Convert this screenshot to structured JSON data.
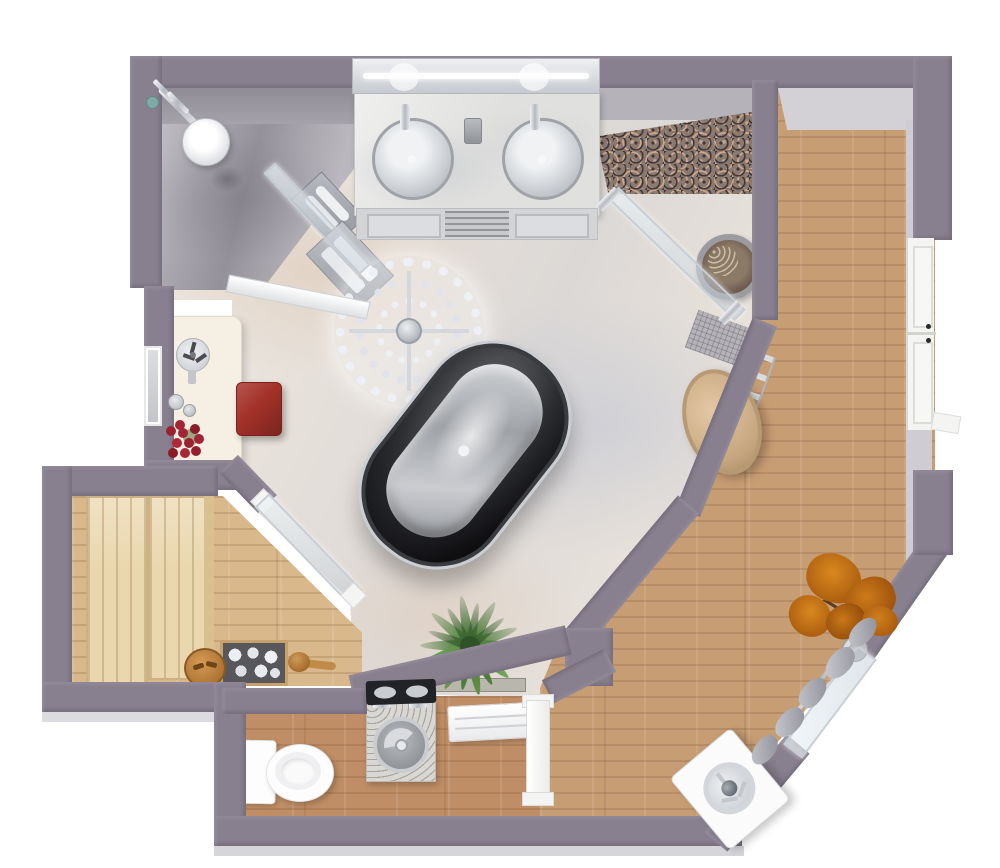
{
  "meta": {
    "type": "3d-floor-plan-render",
    "description": "Top-down 3D rendering of a luxury master bathroom suite with sauna, walk-in shower, freestanding tub, WC and wood-floored dressing corridor",
    "canvas": {
      "width": 1000,
      "height": 868
    }
  },
  "palette": {
    "background": "#ffffff",
    "wall": "#887f8f",
    "wall_inner_face": "#d2cfd5",
    "marble_floor": "#e7e1da",
    "shower_floor": "#a7a4ac",
    "granite": "#8d7a6d",
    "corridor_wood": "#c79d74",
    "wc_wood": "#c08e66",
    "sauna_floor_wood": "#d9b88c",
    "sauna_bench_wood": "#ead7ae",
    "glass": "#d9e2e9",
    "chrome": "#d2d5da",
    "tub_outer": "#1c1c20",
    "tub_inner": "#b9bcc1",
    "fixture_white": "#fbfbfc",
    "ottoman_red": "#a33129",
    "pouf_tan": "#d4b48e",
    "plant_green": "#527f3e",
    "plant_orange": "#c27414",
    "dressing_table_cream": "#f6f0e4",
    "stone_white": "#e9ecef",
    "shelf_black": "#222326"
  },
  "rooms": [
    {
      "id": "main-bathroom",
      "floor": "light marble"
    },
    {
      "id": "shower-area",
      "floor": "gray marble"
    },
    {
      "id": "granite-nook",
      "floor": "granite"
    },
    {
      "id": "sauna",
      "floor": "wood with pale benches"
    },
    {
      "id": "wc-laundry",
      "floor": "wood"
    },
    {
      "id": "corridor-closet",
      "floor": "wood"
    }
  ],
  "furniture": [
    {
      "id": "double-vanity"
    },
    {
      "id": "vanity-mirror"
    },
    {
      "id": "sink-left"
    },
    {
      "id": "sink-right"
    },
    {
      "id": "crystal-chandelier"
    },
    {
      "id": "freestanding-bathtub"
    },
    {
      "id": "dressing-table"
    },
    {
      "id": "table-fan"
    },
    {
      "id": "perfume-bottles"
    },
    {
      "id": "rose-bouquet"
    },
    {
      "id": "leaning-mirror"
    },
    {
      "id": "red-ottoman"
    },
    {
      "id": "rain-shower-head"
    },
    {
      "id": "shower-valves"
    },
    {
      "id": "floor-drain"
    },
    {
      "id": "towel-bench"
    },
    {
      "id": "towel-rack"
    },
    {
      "id": "shower-glass-partition"
    },
    {
      "id": "granite-glass-partition"
    },
    {
      "id": "planter-pot"
    },
    {
      "id": "round-pouf"
    },
    {
      "id": "towel-ladder"
    },
    {
      "id": "wall-mat"
    },
    {
      "id": "palm-plant"
    },
    {
      "id": "planter-trough"
    },
    {
      "id": "sauna-bench-upper"
    },
    {
      "id": "sauna-bench-lower"
    },
    {
      "id": "sauna-stones"
    },
    {
      "id": "wooden-bowl"
    },
    {
      "id": "sauna-ladle"
    },
    {
      "id": "sauna-glass-door"
    },
    {
      "id": "toilet"
    },
    {
      "id": "laundry-sink-unit"
    },
    {
      "id": "radiator"
    },
    {
      "id": "wc-door"
    },
    {
      "id": "closet-double-doors"
    },
    {
      "id": "curtained-glass-door"
    },
    {
      "id": "curtains"
    },
    {
      "id": "autumn-plant"
    },
    {
      "id": "washing-machine"
    }
  ]
}
